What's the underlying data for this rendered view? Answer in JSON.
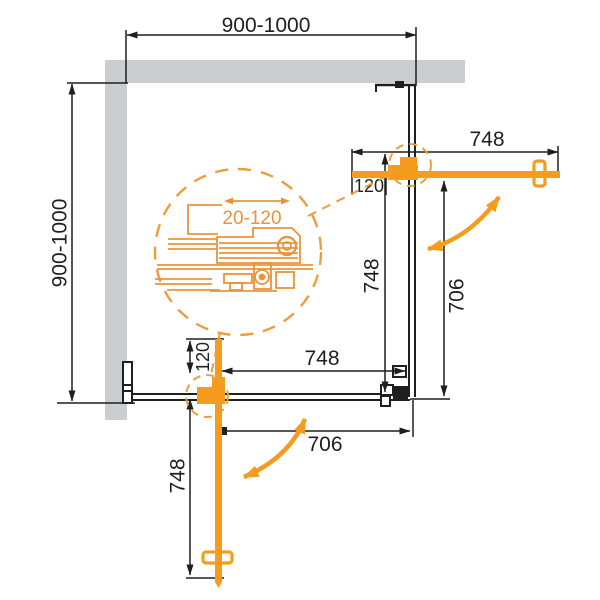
{
  "colors": {
    "wall": "#CBCED0",
    "line": "#1F1F1F",
    "accent": "#F59C1F",
    "detail": "#E9943A",
    "background": "#FFFFFF"
  },
  "dimensions": {
    "overall_width": "900-1000",
    "overall_depth": "900-1000",
    "top_door": {
      "width": "748",
      "pivot_offset": "120"
    },
    "right_side": {
      "panel_width": "748",
      "opening_width": "706"
    },
    "bottom_door": {
      "width": "748",
      "opening_width": "706",
      "pivot_offset": "120",
      "open_length": "748"
    },
    "roller_detail": {
      "adjustment_range": "20-120"
    }
  },
  "annotations": {
    "top_door_swing": "double-curved-arrow",
    "bottom_door_swing": "double-curved-arrow",
    "detail_adjust_arrow": "double-horizontal-arrow"
  }
}
